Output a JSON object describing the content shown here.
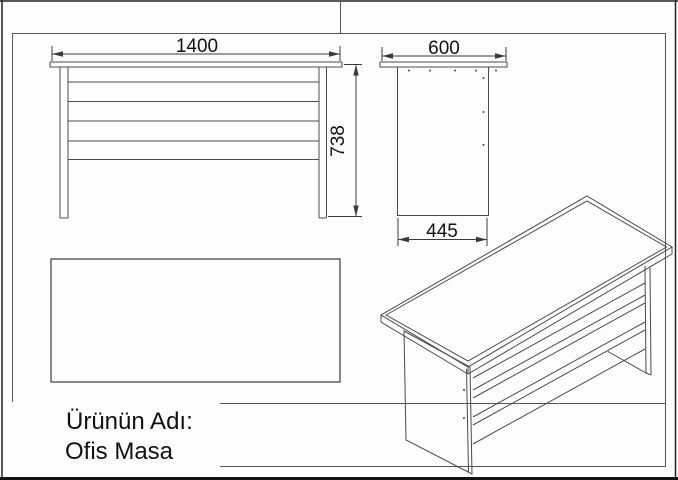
{
  "sheet": {
    "title_label": "Ürünün Adı:",
    "product_name": "Ofis Masa"
  },
  "dimensions": {
    "front_width_mm": "1400",
    "front_height_mm": "738",
    "side_top_depth_mm": "600",
    "side_bottom_depth_mm": "445"
  },
  "views": {
    "front": "front-elevation-of-desk",
    "side": "side-elevation-of-desk",
    "top": "top-plan-of-desk",
    "iso": "isometric-wireframe-of-desk"
  },
  "colors": {
    "line": "#4a4a4a",
    "frame": "#555555",
    "text": "#111111",
    "background": "#fdfdfd"
  }
}
